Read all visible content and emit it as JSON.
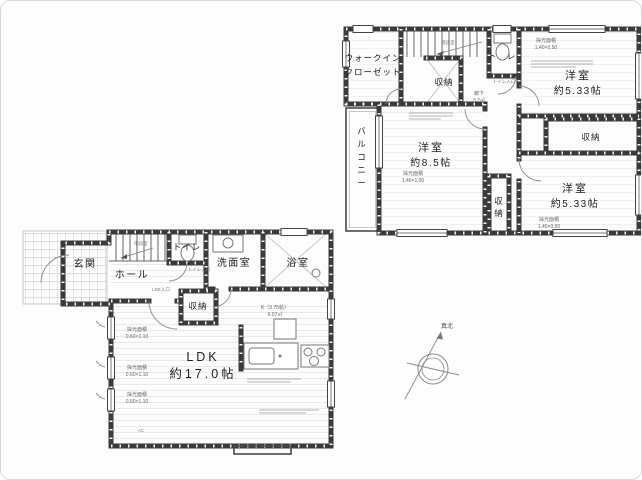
{
  "floor2": {
    "wic_line1": "ウォークイン",
    "wic_line2": "クローゼット",
    "stair": "階段室",
    "corridor": "廊下",
    "corridor_area": "3.2㎡",
    "toilet": "トイレ",
    "toilet_door": "トイレ入口",
    "closet_by_stairs": "収納",
    "closet_right": "収納",
    "closet_center_v1": "収",
    "closet_center_v2": "納",
    "room1_name": "洋室",
    "room1_size": "約5.33帖",
    "room2_name": "洋室",
    "room2_size": "約5.33帖",
    "room3_name": "洋室",
    "room3_size": "約8.5帖",
    "light_label": "採光面積",
    "light_room1": "1.40×0.50",
    "light_room2": "1.40×0.50",
    "light_room3": "1.40×1.00",
    "balcony": [
      "バ",
      "ル",
      "コ",
      "ニ",
      "ー"
    ]
  },
  "floor1": {
    "entrance": "玄関",
    "hall": "ホール",
    "stair": "階段室",
    "toilet": "トイレ",
    "toilet_door": "トイレ入口",
    "washroom": "洗面室",
    "bath": "浴室",
    "closet": "収納",
    "ldk_entry": "LDK入口",
    "ldk_name": "LDK",
    "ldk_size": "約17.0帖",
    "kitchen_label": "K（3.75帖）",
    "kitchen_area": "6.07㎡",
    "light_label": "採光面積",
    "light_val": "0.60×1.10",
    "ac": "AC"
  },
  "compass": {
    "north": "真北"
  },
  "colors": {
    "line": "#3a3a3a",
    "annotation": "#666666",
    "floor": "#e3e3e3"
  }
}
